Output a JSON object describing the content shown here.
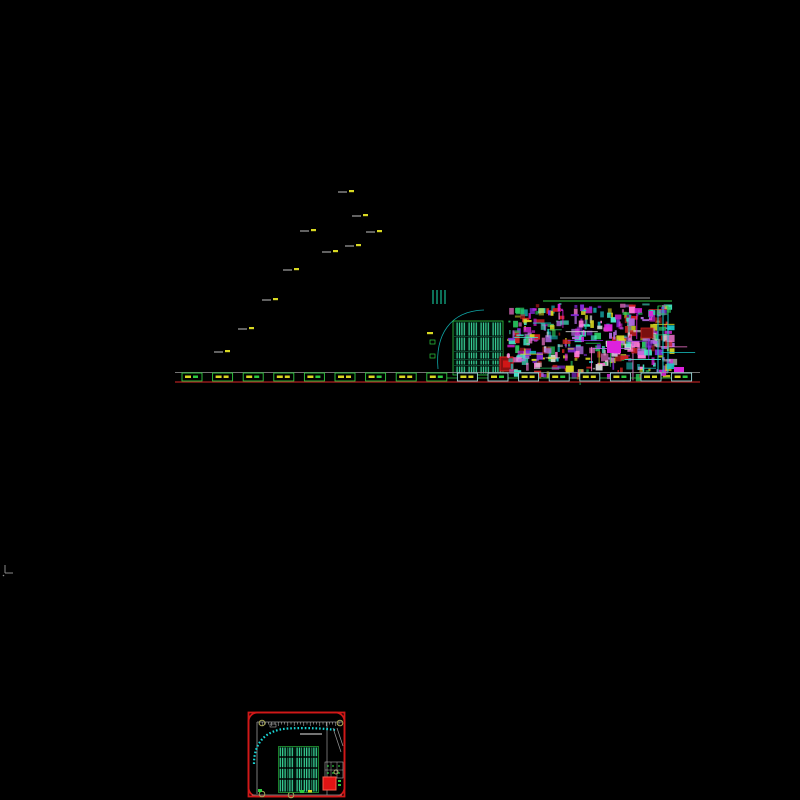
{
  "canvas": {
    "width": 800,
    "height": 800,
    "background": "#000000"
  },
  "regions": {
    "viewport": "model-space-viewport",
    "plan": "ground-floor-plan",
    "wing": "rotated-wing-block",
    "triangle": "site-boundary-triangle",
    "walkway": "curved-walkway-band",
    "tower": "stage-tower-truss",
    "arc": "proscenium-arc",
    "seating": "auditorium-seating",
    "equipment": "equipment-room-cluster",
    "footings": "column-footing-row",
    "thumbnail": "detail-callout-drawing"
  },
  "grid": {
    "bubble_counts": {
      "top": 42,
      "bottom": 42,
      "left": 25,
      "right": 25
    },
    "column_lines": 29,
    "row_lines": 17
  },
  "palette": {
    "background": "#000000",
    "viewport_border": "#8f8f8f",
    "grid_line": "#5c5c5c",
    "grid_bright": "#787878",
    "bubble_cyan": "#2bd8d8",
    "dash_orange": "#d2883c",
    "dash_yellow": "#d6d24a",
    "green": "#2ecc40",
    "green_dark": "#1f8f3a",
    "mint": "#3fe8a8",
    "teal_bar": "#19e0b0",
    "lattice_red": "#7c2f2f",
    "block_red": "#cf1818",
    "dark_red": "#8f1414",
    "orange": "#e07d1a",
    "orange_dark": "#8a4a10",
    "magenta": "#dd22dd",
    "pink": "#ff4f9e",
    "yellow": "#d8d822",
    "white_detail": "#d9d9d9",
    "baseline_red": "#b02020",
    "purple": "#8a2be2",
    "olive": "#a8a85a",
    "cyan_arc": "#19d6d6"
  },
  "noise_palette": [
    "#dd22dd",
    "#18c8c8",
    "#28c860",
    "#d8d822",
    "#d0d0d0",
    "#8a2be2",
    "#cc2020",
    "#ff7ad9",
    "#45e8c8",
    "#b06ae0"
  ]
}
